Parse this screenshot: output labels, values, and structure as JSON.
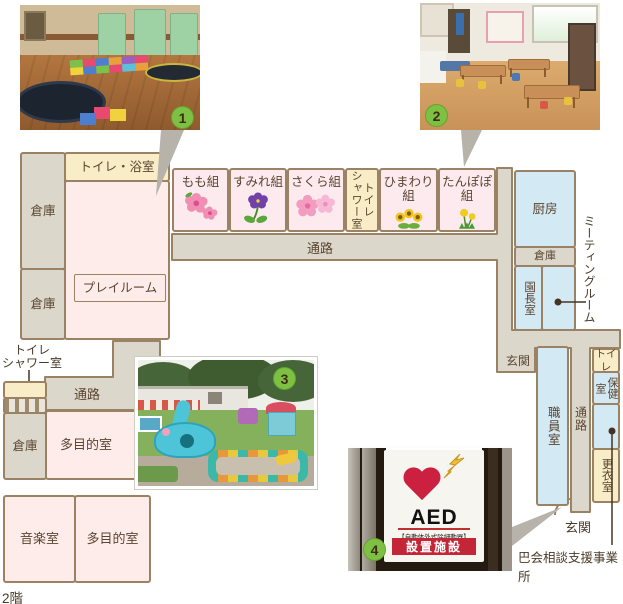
{
  "floor_note": "2階",
  "badges": {
    "b1": "1",
    "b2": "2",
    "b3": "3",
    "b4": "4"
  },
  "labels": {
    "toilet_bath": "トイレ・浴室",
    "storage": "倉庫",
    "playroom": "プレイルーム",
    "corridor": "通路",
    "toilet_shower": "トイレ\nシャワー室",
    "kitchen": "厨房",
    "principal_office": "園長室",
    "meeting_room": "ミーティングルーム",
    "entrance": "玄関",
    "staff_room": "職員室",
    "toilet": "トイレ",
    "health_room": "保健室",
    "changing_room": "更衣室",
    "support_office": "巴会相談支援事業所",
    "music_room": "音楽室",
    "multipurpose_room": "多目的室"
  },
  "classrooms": [
    {
      "label": "もも組",
      "icon": "peach-blossom-icon"
    },
    {
      "label": "すみれ組",
      "icon": "violet-icon"
    },
    {
      "label": "さくら組",
      "icon": "cherry-blossom-icon"
    },
    {
      "label": "ひまわり組",
      "icon": "sunflower-icon"
    },
    {
      "label": "たんぽぽ組",
      "icon": "dandelion-icon"
    }
  ],
  "aed_sign": {
    "brand": "SECOM",
    "title": "AED",
    "note": "【自動体外式除細動器】",
    "banner": "設置施設"
  },
  "colors": {
    "wall": "#9c8265",
    "corridor": "#dcd7cb",
    "room_pink": "#fdecea",
    "room_yellow": "#f8edc6",
    "room_blue": "#d3e9f3",
    "badge_green": "#7ec043",
    "pointer_gray": "#b7b3ab",
    "text": "#5a4531"
  }
}
